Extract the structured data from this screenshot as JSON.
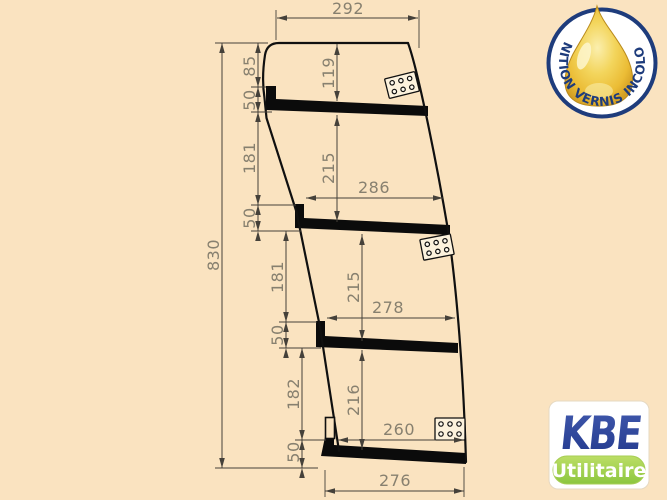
{
  "page": {
    "background_color": "#FAE3C0"
  },
  "drawing": {
    "description": "technical side profile of tilted shelving unit with dimension chains",
    "line_color": "#101010",
    "dim_line_color": "#45413A",
    "dim_text_color": "#87806F",
    "dims": {
      "total_height": "830",
      "top_width": "292",
      "bottom_width": "276",
      "sec1_offset": "85",
      "sec1_lip": "50",
      "sec1_interior": "119",
      "sec2_gap": "181",
      "sec2_lip": "50",
      "sec2_interior": "215",
      "sec2_width": "286",
      "sec3_gap": "181",
      "sec3_lip": "50",
      "sec3_interior": "215",
      "sec3_width": "278",
      "sec4_gap": "182",
      "sec4_lip": "50",
      "sec4_interior": "216",
      "sec4_width": "260"
    }
  },
  "badge": {
    "text": "FINITION VERNIS INCOLORE",
    "ring_color": "#1E3C7C",
    "drop_color": "#EBBC35"
  },
  "logo": {
    "brand": "KBE",
    "subtitle": "Utilitaire",
    "brand_color": "#22398C",
    "subtitle_bg": "#8CC63F"
  }
}
